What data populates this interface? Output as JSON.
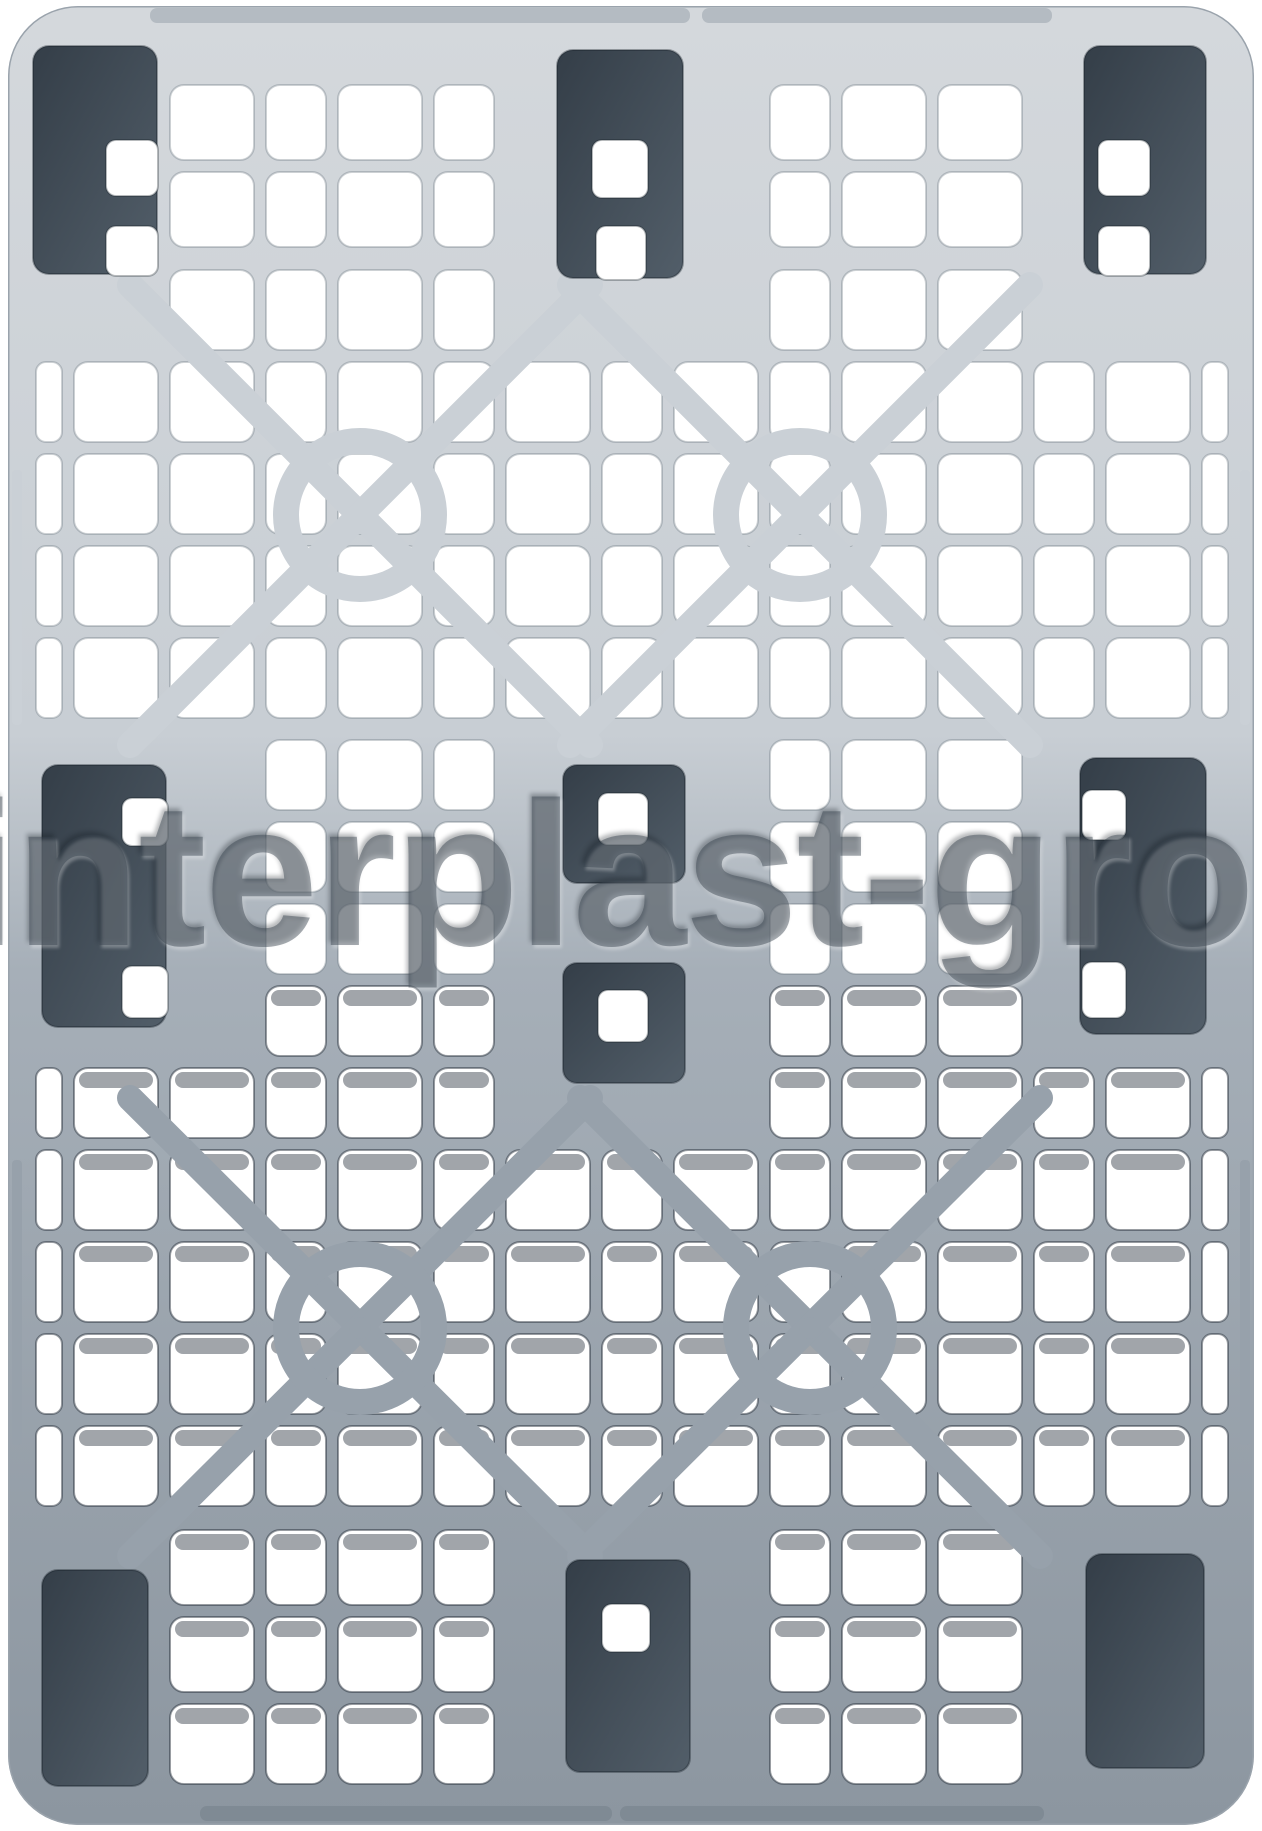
{
  "image": {
    "description": "Top view product photo of a grey nestable plastic pallet with perforated mesh deck, diagonal cross braces and nine dark stacking feet",
    "background": "#ffffff"
  },
  "watermark": {
    "text": "interplast-gro",
    "color": "rgba(56,66,78,0.45)"
  },
  "palette": {
    "deck_top": "#d4d8dc",
    "deck_upper": "#c8ced4",
    "deck_transition": "#a6afb8",
    "deck_bottom": "#8c96a0",
    "beam_light": "#cad0d6",
    "beam_dark": "#97a1ab",
    "foot_dark": "#343e48",
    "foot_mid": "#525e69",
    "hole_fill": "#ffffff",
    "hole_edge_light": "rgba(90,102,114,0.30)",
    "hole_edge_dark": "rgba(28,38,48,0.45)",
    "hole_shadow": "rgba(30,40,52,0.42)",
    "edge_tab_light": "#b4bbc2",
    "edge_tab_dark": "#7f8a94",
    "outline": "#9aa3ac"
  }
}
